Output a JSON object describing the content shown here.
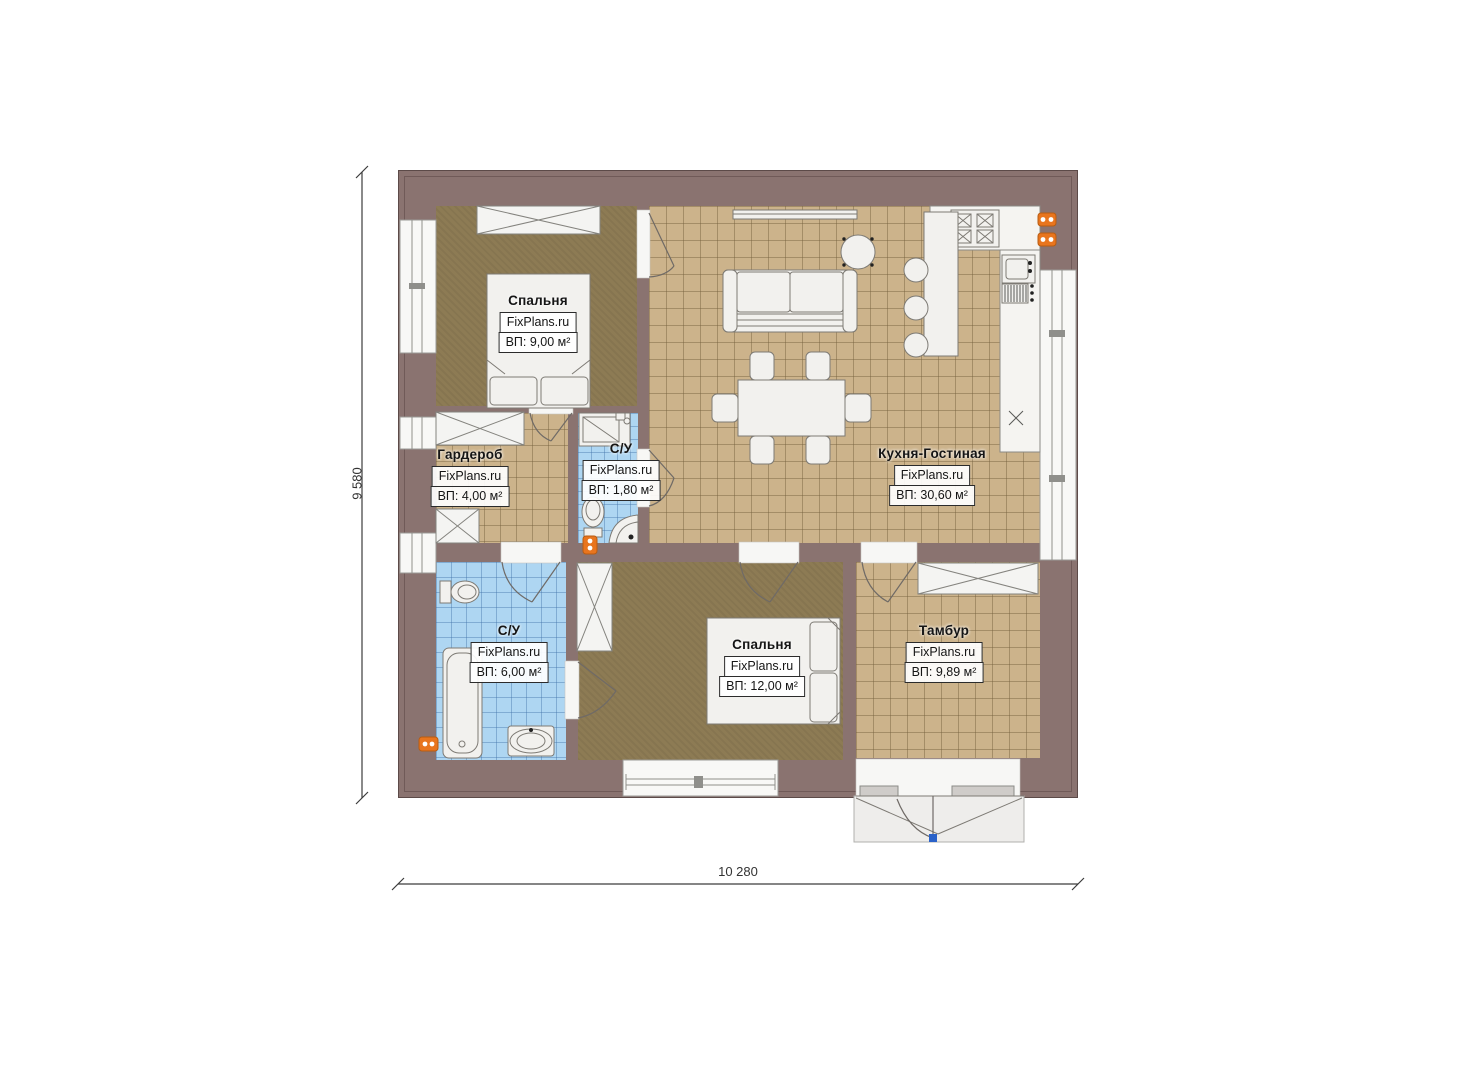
{
  "plan": {
    "watermark": "FixPlans.ru",
    "rooms": [
      {
        "key": "bedroom-top",
        "name": "Спальня",
        "area": "ВП: 9,00 м²"
      },
      {
        "key": "wardrobe",
        "name": "Гардероб",
        "area": "ВП: 4,00 м²"
      },
      {
        "key": "wc-small",
        "name": "С/У",
        "area": "ВП: 1,80 м²"
      },
      {
        "key": "kitchen-living",
        "name": "Кухня-Гостиная",
        "area": "ВП: 30,60 м²"
      },
      {
        "key": "bathroom",
        "name": "С/У",
        "area": "ВП: 6,00 м²"
      },
      {
        "key": "bedroom-bottom",
        "name": "Спальня",
        "area": "ВП: 12,00 м²"
      },
      {
        "key": "vestibule",
        "name": "Тамбур",
        "area": "ВП: 9,89 м²"
      }
    ],
    "dimensions": {
      "width": "10 280",
      "height": "9 580"
    },
    "colors": {
      "wall": "#8a7370",
      "floor_tan": "#ccb38b",
      "floor_brown": "#8d7b54",
      "floor_blue": "#aed6f2",
      "accent_orange": "#e8751e",
      "porch": "#eeedeb",
      "handle_blue": "#2a62c9"
    }
  }
}
